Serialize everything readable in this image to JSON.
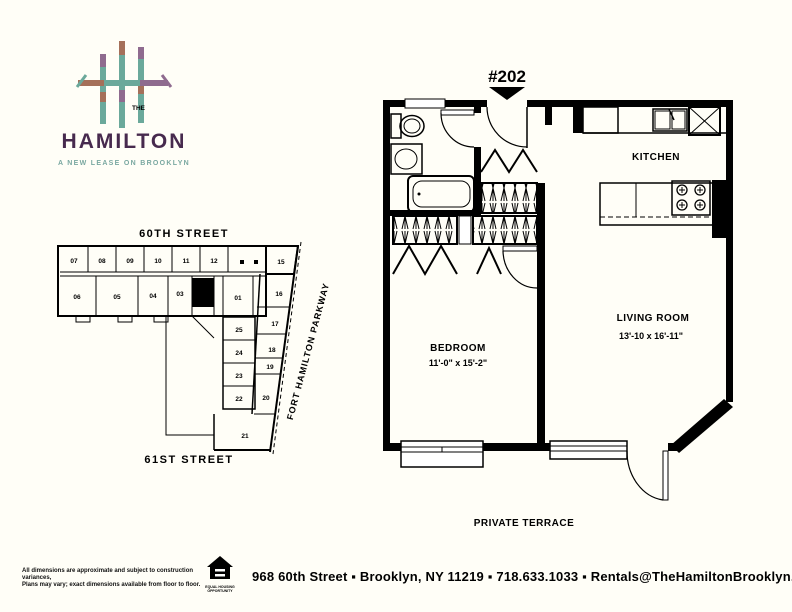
{
  "page": {
    "background": "#fffef7"
  },
  "logo": {
    "the": "THE",
    "title": "HAMILTON",
    "tagline": "A NEW LEASE ON BROOKLYN",
    "colors": {
      "purple": "#472a4e",
      "teal": "#6ba99b",
      "rust": "#a5705a",
      "tagline_teal": "#7aa8a1"
    }
  },
  "unit_callout": {
    "label": "#202"
  },
  "floor_plan": {
    "kitchen": {
      "label": "KITCHEN"
    },
    "living_room": {
      "label": "LIVING ROOM",
      "dimensions": "13'-10 x 16'-11\""
    },
    "bedroom": {
      "label": "BEDROOM",
      "dimensions": "11'-0\" x 15'-2\""
    },
    "terrace": {
      "label": "PRIVATE TERRACE"
    }
  },
  "site_plan": {
    "street_top": "60TH STREET",
    "street_bottom": "61ST STREET",
    "street_right": "FORT HAMILTON PARKWAY",
    "highlighted_unit": "02",
    "units": [
      {
        "id": "07",
        "x": 26,
        "y": 41
      },
      {
        "id": "08",
        "x": 54,
        "y": 41
      },
      {
        "id": "09",
        "x": 82,
        "y": 41
      },
      {
        "id": "10",
        "x": 110,
        "y": 41
      },
      {
        "id": "11",
        "x": 138,
        "y": 41
      },
      {
        "id": "12",
        "x": 166,
        "y": 41
      },
      {
        "id": "15",
        "x": 233,
        "y": 42
      },
      {
        "id": "06",
        "x": 29,
        "y": 77
      },
      {
        "id": "05",
        "x": 69,
        "y": 77
      },
      {
        "id": "04",
        "x": 105,
        "y": 76
      },
      {
        "id": "03",
        "x": 132,
        "y": 74
      },
      {
        "id": "01",
        "x": 190,
        "y": 78
      },
      {
        "id": "16",
        "x": 231,
        "y": 74
      },
      {
        "id": "17",
        "x": 227,
        "y": 104
      },
      {
        "id": "18",
        "x": 224,
        "y": 130
      },
      {
        "id": "19",
        "x": 222,
        "y": 147
      },
      {
        "id": "20",
        "x": 218,
        "y": 178
      },
      {
        "id": "21",
        "x": 197,
        "y": 216
      },
      {
        "id": "25",
        "x": 191,
        "y": 110
      },
      {
        "id": "24",
        "x": 191,
        "y": 133
      },
      {
        "id": "23",
        "x": 191,
        "y": 156
      },
      {
        "id": "22",
        "x": 191,
        "y": 179
      }
    ]
  },
  "footer": {
    "disclaimer_line1": "All dimensions are approximate and subject to construction variances,",
    "disclaimer_line2": "Plans may vary; exact dimensions available from floor to floor.",
    "equal_housing_line1": "EQUAL HOUSING",
    "equal_housing_line2": "OPPORTUNITY",
    "address": "968 60th Street ▪ Brooklyn, NY  11219 ▪ 718.633.1033 ▪ Rentals@TheHamiltonBrooklyn.com"
  }
}
